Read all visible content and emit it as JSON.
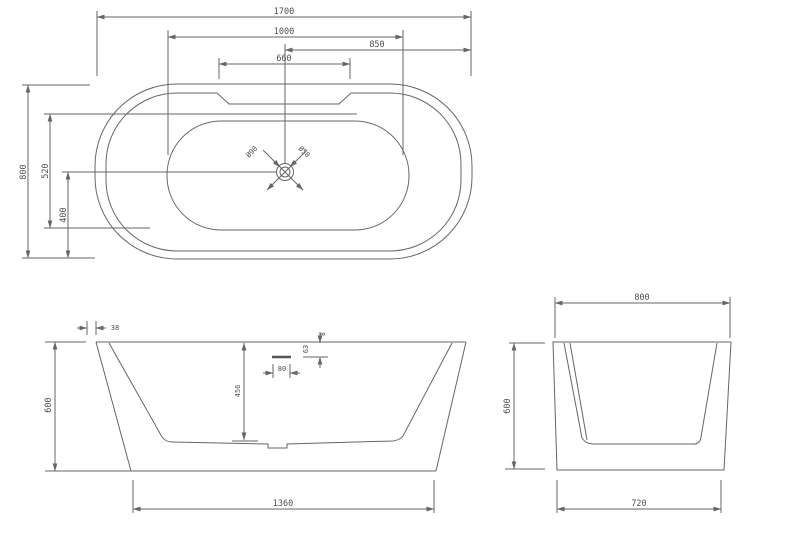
{
  "top_view": {
    "dim_length": "1700",
    "dim_inner_length": "1000",
    "dim_center_to_right": "850",
    "dim_deck_width": "660",
    "dim_width": "800",
    "dim_inner_width": "520",
    "dim_drain_offset": "400",
    "dim_drain_outer": "Ø90",
    "dim_drain_inner": "Ø50"
  },
  "front_view": {
    "dim_rim_lip": "38",
    "dim_height": "600",
    "dim_depth": "456",
    "dim_overflow_width": "80",
    "dim_overflow_offset": "63",
    "dim_overflow_small": "8",
    "dim_bottom_length": "1360"
  },
  "side_view": {
    "dim_width": "800",
    "dim_height": "600",
    "dim_bottom_width": "720"
  },
  "colors": {
    "line": "#666666",
    "text": "#4d4d4d",
    "background": "#ffffff"
  }
}
